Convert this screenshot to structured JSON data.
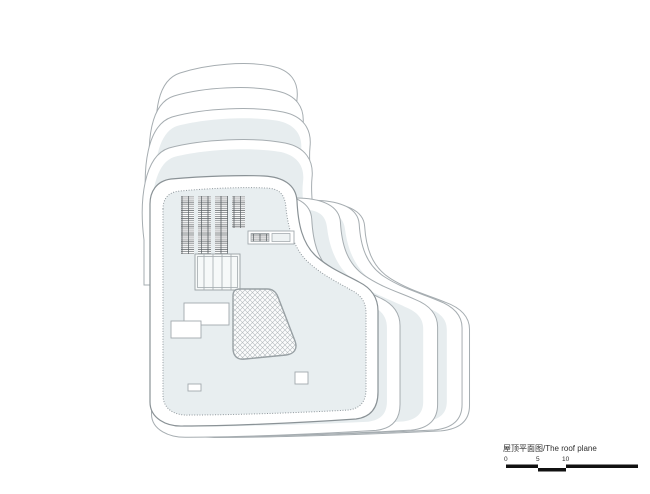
{
  "title_block": {
    "title": "屋顶平面图/The roof plane",
    "scale": {
      "ticks": [
        "0",
        "5",
        "10"
      ]
    }
  },
  "colors": {
    "background": "#ffffff",
    "roof_fill": "#e8eef0",
    "plate_fill": "#e7edef",
    "plate_stroke": "#a6adb1",
    "main_stroke": "#8a9296",
    "panel_line": "#565c60",
    "hatch_line": "#b3b9bd",
    "hatch_bg": "#fbfcfc",
    "text": "#2f2f2f",
    "scale_bar": "#111111"
  }
}
